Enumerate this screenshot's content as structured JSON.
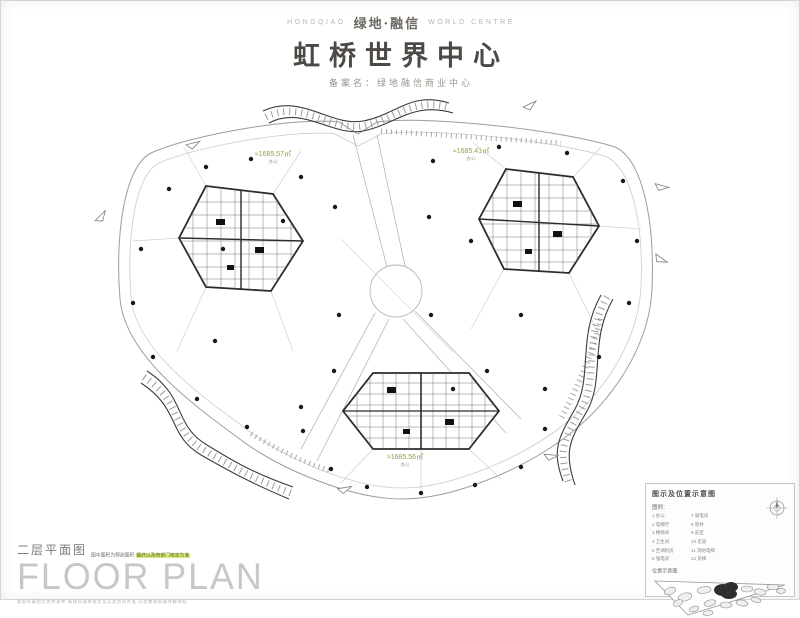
{
  "header": {
    "brand_left": "HONGQIAO",
    "brand_center": "绿地·融信",
    "brand_right": "WORLD CENTRE",
    "title": "虹桥世界中心",
    "subtitle": "备案名：绿地融信商业中心"
  },
  "plan": {
    "area_labels": [
      {
        "value": "≈1685.57㎡",
        "sub": "办公"
      },
      {
        "value": "≈1685.41㎡",
        "sub": "办公"
      },
      {
        "value": "≈1685.56㎡",
        "sub": "办公"
      }
    ]
  },
  "footer": {
    "plan_name": "二层平面图",
    "note_plain": "图中面积为预测面积",
    "note_highlight": "最终以政府部门核定为准",
    "big_title": "FLOOR PLAN",
    "fine_print": "本案所载图文仅供参考  具体以政府批文及买卖合同为准  开发商保留最终解释权"
  },
  "legend": {
    "title": "图示及位置示意图",
    "label": "图例：",
    "col1": [
      "1  办公",
      "2  电梯厅",
      "3  楼梯间",
      "4  卫生间",
      "5  空调机房",
      "6  强电间"
    ],
    "col2": [
      "7  弱电间",
      "8  管井",
      "9  前室",
      "10 走道",
      "11 消防电梯",
      "12 货梯"
    ],
    "map_label": "位置示意图",
    "compass_icon": "compass-rose-icon"
  },
  "colors": {
    "accent_green": "#8fa43b",
    "highlight": "#d9ec7a",
    "line_gray": "#9a9a9a",
    "tower_dark": "#2b2b2b"
  }
}
